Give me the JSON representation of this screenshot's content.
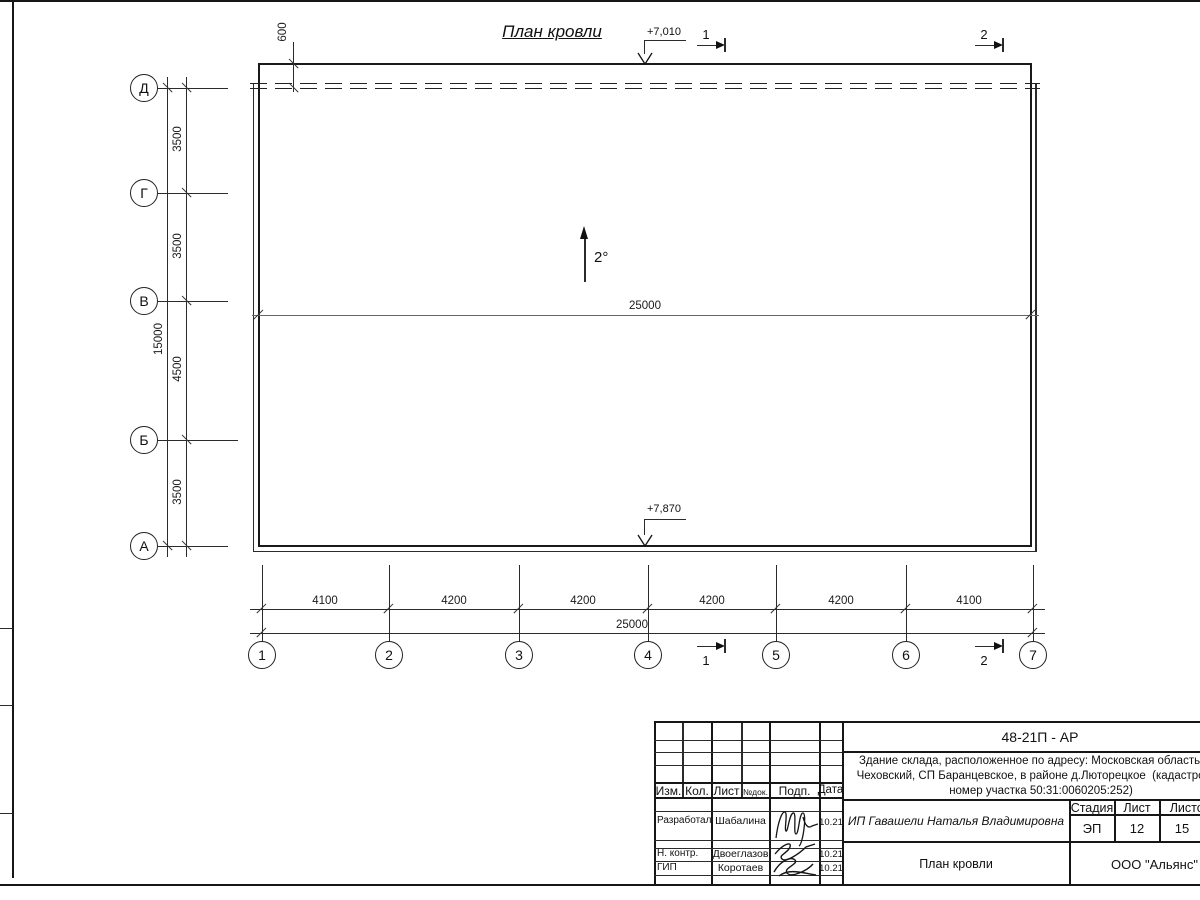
{
  "sheet": {
    "title": "План кровли"
  },
  "roof": {
    "slope": "2°",
    "ridge_dim": "25000",
    "parapet_dim": "600",
    "elev_top": "+7,010",
    "elev_bottom": "+7,870"
  },
  "axes": {
    "rows": [
      "Д",
      "Г",
      "В",
      "Б",
      "А"
    ],
    "cols": [
      "1",
      "2",
      "3",
      "4",
      "5",
      "6",
      "7"
    ]
  },
  "dims": {
    "left_segments": [
      "3500",
      "3500",
      "4500",
      "3500"
    ],
    "left_total": "15000",
    "bottom_segments": [
      "4100",
      "4200",
      "4200",
      "4200",
      "4200",
      "4100"
    ],
    "bottom_total": "25000"
  },
  "sections": {
    "s1": "1",
    "s2": "2"
  },
  "title_block": {
    "doc_number": "48-21П - АР",
    "desc": [
      "Здание склада, расположенное по адресу: Московская область, р-н",
      "Чеховский, СП Баранцевское, в районе д.Люторецкое  (кадастровый",
      "номер участка 50:31:0060205:252)"
    ],
    "cols": {
      "izm": "Изм.",
      "kol": "Кол.",
      "list": "Лист",
      "ndok": "№док.",
      "podp": "Подп.",
      "data": "Дата"
    },
    "roles": [
      {
        "role": "Разработал",
        "name": "Шабалина",
        "date": "10.21"
      },
      {
        "role": "Н. контр.",
        "name": "Двоеглазов",
        "date": "10.21"
      },
      {
        "role": "ГИП",
        "name": "Коротаев",
        "date": "10.21"
      }
    ],
    "client": "ИП Гавашели Наталья Владимировна",
    "stage_label": "Стадия",
    "sheet_label": "Лист",
    "sheets_label": "Листов",
    "stage": "ЭП",
    "sheet": "12",
    "sheets": "15",
    "sheet_title": "План кровли",
    "company": "ООО \"Альянс\""
  }
}
